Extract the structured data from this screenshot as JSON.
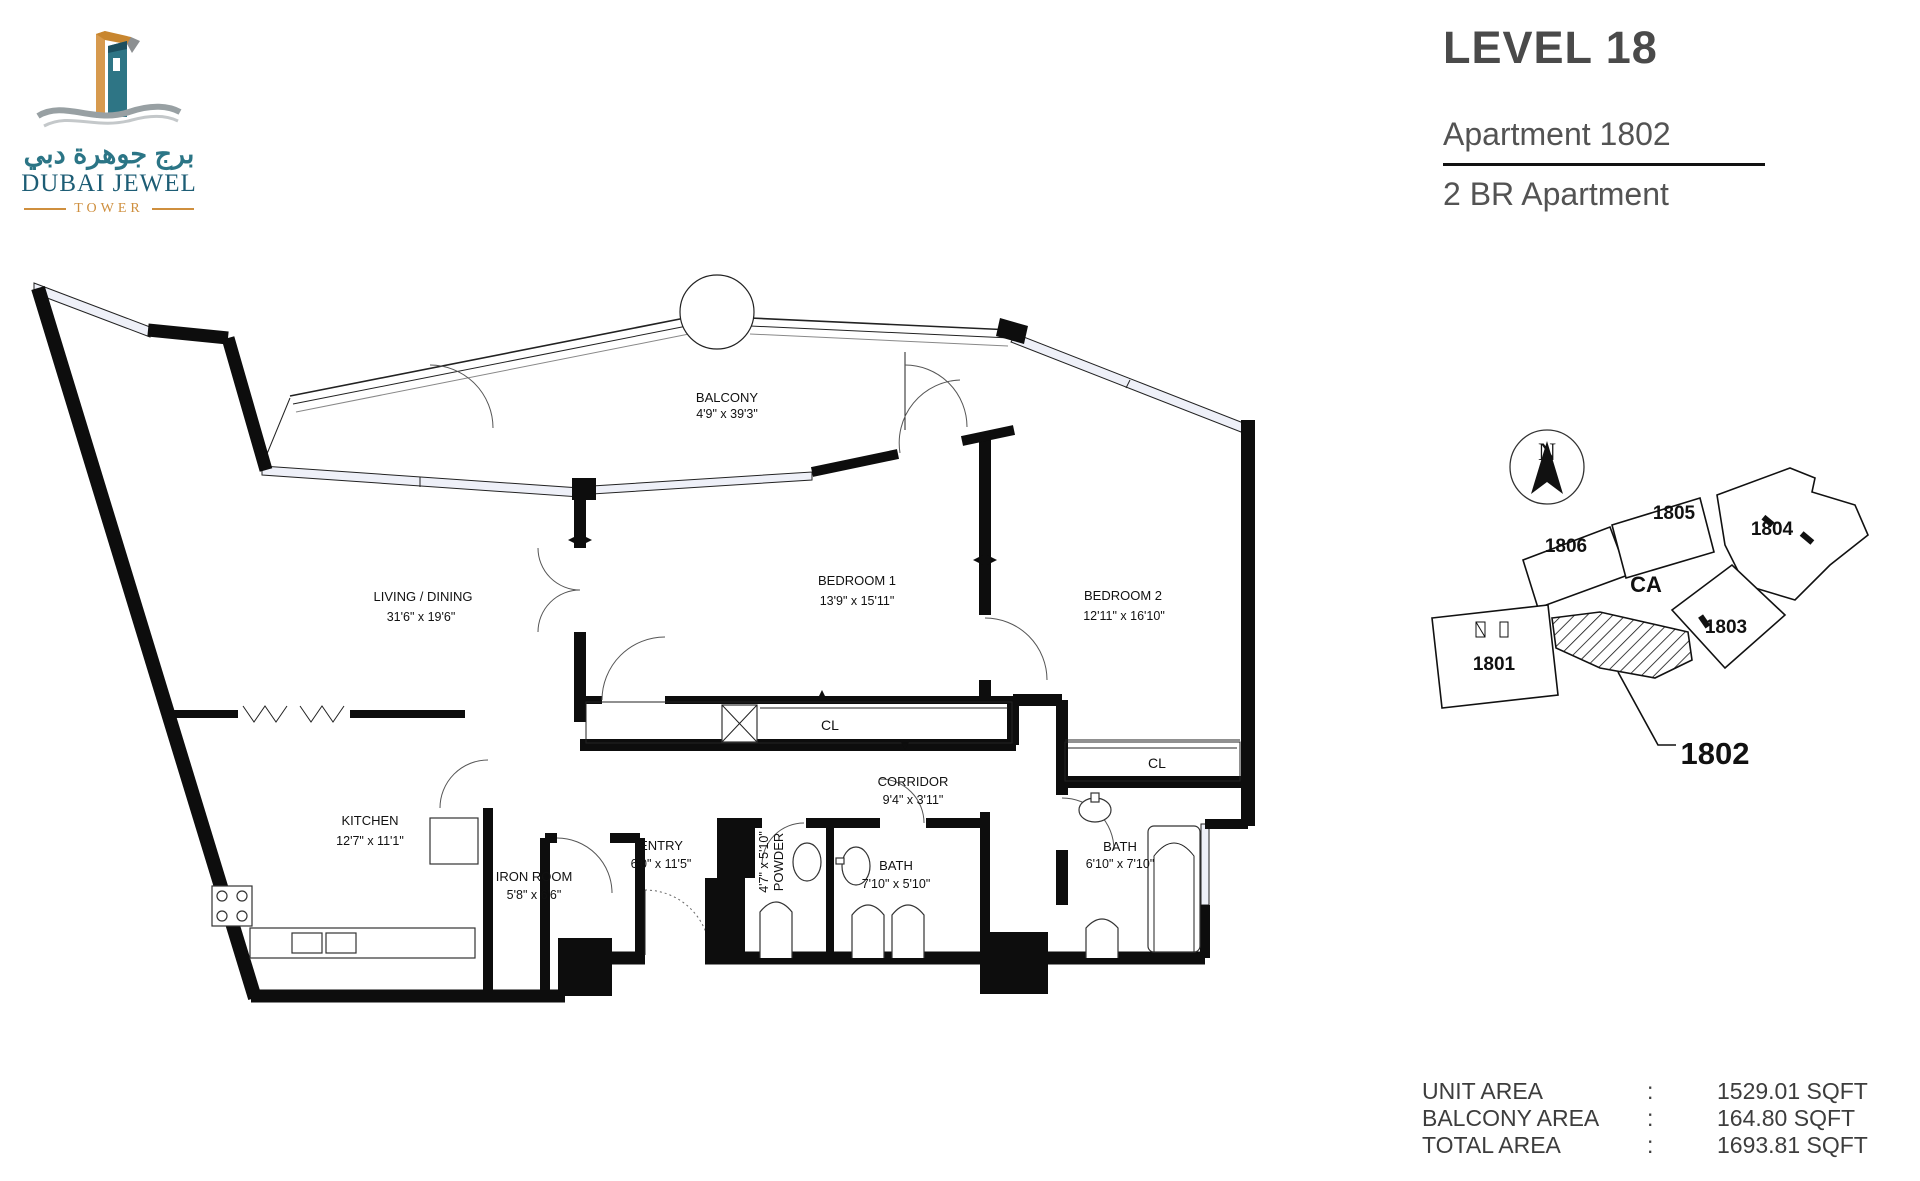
{
  "colors": {
    "teal": "#2b7586",
    "dark_teal": "#1d5d75",
    "orange": "#cf8f3e",
    "header_text": "#4d4d4d",
    "plan_line": "#111111"
  },
  "logo": {
    "arabic": "برج جوهرة دبي",
    "name": "DUBAI JEWEL",
    "subtitle": "TOWER"
  },
  "header": {
    "level": "LEVEL 18",
    "apartment": "Apartment 1802",
    "type": "2 BR Apartment"
  },
  "floor_plan": {
    "rooms": [
      {
        "name": "BALCONY",
        "dims": "4'9\" x 39'3\""
      },
      {
        "name": "LIVING / DINING",
        "dims": "31'6\" x 19'6\""
      },
      {
        "name": "BEDROOM 1",
        "dims": "13'9\" x 15'11\""
      },
      {
        "name": "BEDROOM 2",
        "dims": "12'11\" x 16'10\""
      },
      {
        "name": "KITCHEN",
        "dims": "12'7\" x 11'1\""
      },
      {
        "name": "IRON ROOM",
        "dims": "5'8\" x 6'6\""
      },
      {
        "name": "ENTRY",
        "dims": "6'0\" x 11'5\""
      },
      {
        "name": "POWDER",
        "dims": "4'7\" x 5'10\""
      },
      {
        "name": "BATH",
        "dims": "7'10\" x 5'10\""
      },
      {
        "name": "CORRIDOR",
        "dims": "9'4\" x 3'11\""
      },
      {
        "name": "BATH",
        "dims": "6'10\" x 7'10\""
      }
    ],
    "closets": [
      "CL",
      "CL"
    ]
  },
  "key_plan": {
    "north_label": "N",
    "unit_1801": "1801",
    "unit_1803": "1803",
    "unit_1804": "1804",
    "unit_1805": "1805",
    "unit_1806": "1806",
    "common_area_label": "CA",
    "callout_label": "1802"
  },
  "areas": {
    "rows": [
      {
        "label": "UNIT AREA",
        "sep": ":",
        "value": "1529.01 SQFT"
      },
      {
        "label": "BALCONY AREA",
        "sep": ":",
        "value": "164.80 SQFT"
      },
      {
        "label": "TOTAL AREA",
        "sep": ":",
        "value": "1693.81 SQFT"
      }
    ]
  }
}
